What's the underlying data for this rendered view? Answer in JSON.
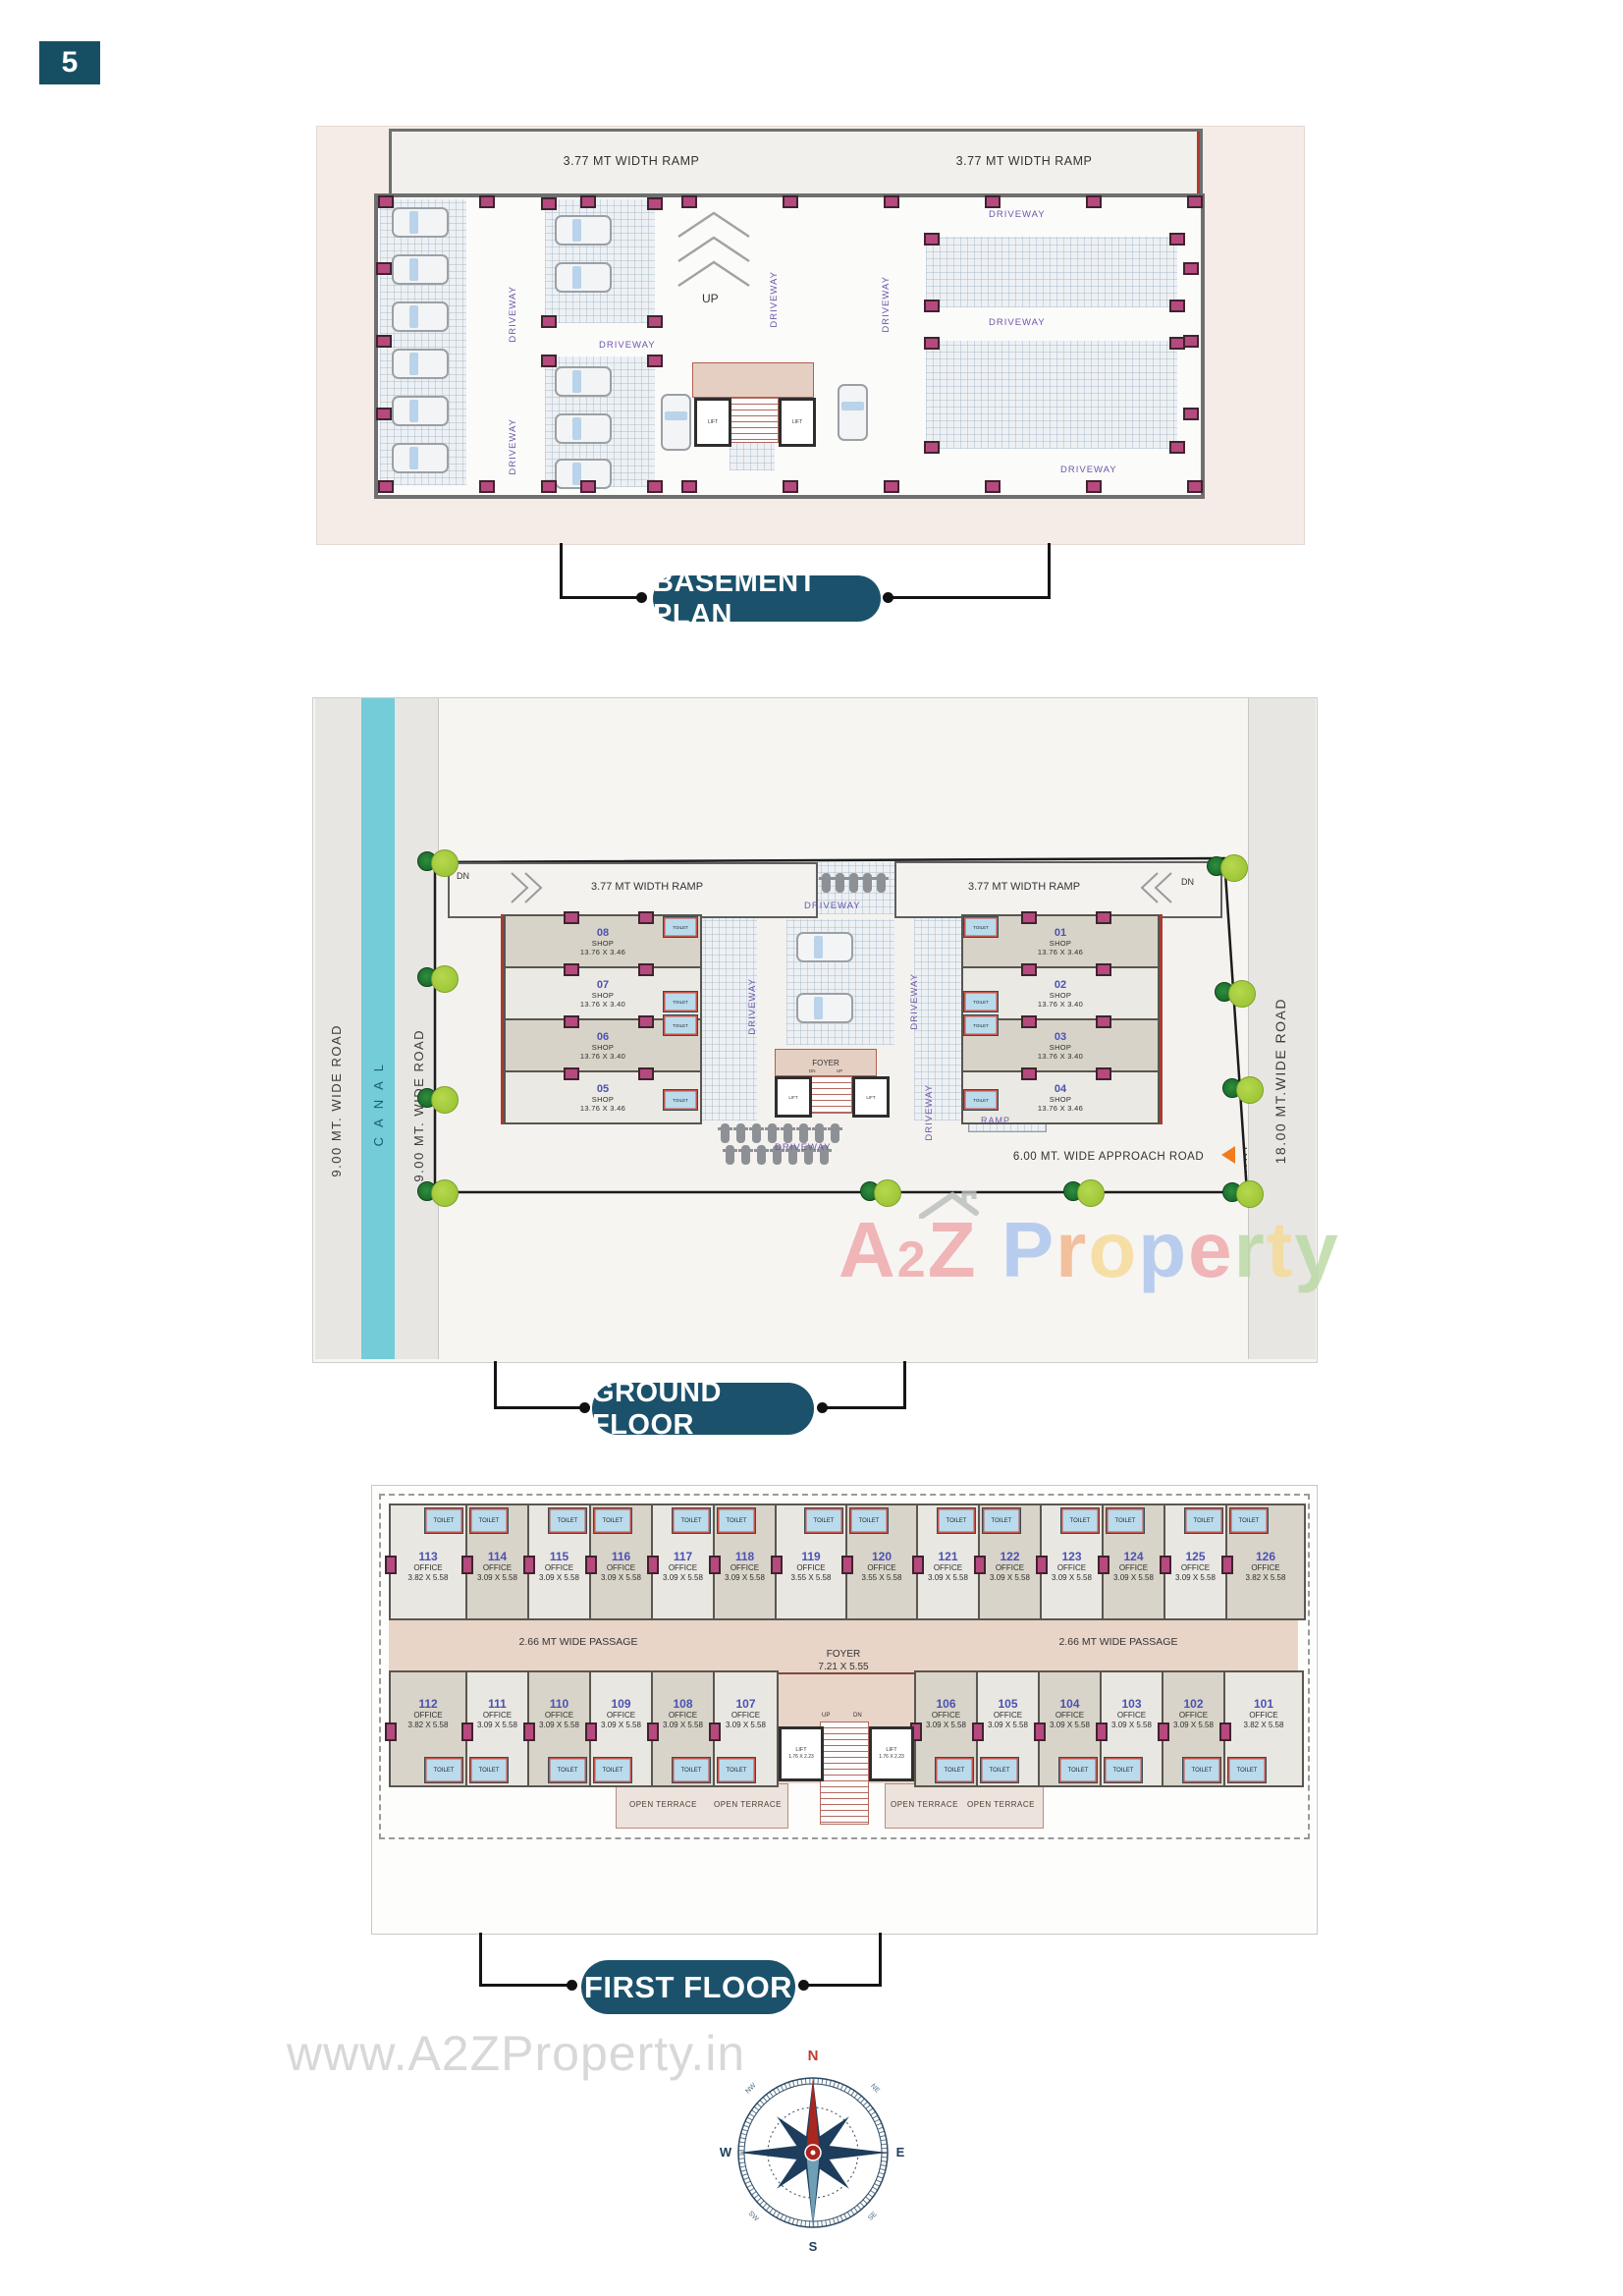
{
  "page_number": "5",
  "theme": {
    "badge_color": "#1b516b",
    "canal_color": "#74ccd9",
    "entry_arrow_color": "#f07c1f",
    "column_color": "#b64a7e",
    "shop_number_color": "#4a52b2",
    "driveway_text_color": "#6f55a8"
  },
  "sections": {
    "basement": {
      "title": "BASEMENT PLAN",
      "ramp_label": "3.77 MT WIDTH RAMP",
      "up_label": "UP",
      "lift_label": "LIFT",
      "driveway_label": "DRIVEWAY"
    },
    "ground": {
      "title": "GROUND FLOOR",
      "road_left_label": "9.00 MT. WIDE ROAD",
      "canal_label": "CANAL",
      "road_inner_label": "9.00 MT. WIDE ROAD",
      "road_right_label": "18.00 MT.WIDE ROAD",
      "entry_label": "ENTRY",
      "dn_label": "DN",
      "up_label": "UP",
      "ramp_label": "3.77 MT WIDTH RAMP",
      "ramp_small_label": "RAMP",
      "approach_label": "6.00 MT. WIDE APPROACH ROAD",
      "driveway_label": "DRIVEWAY",
      "foyer_label": "FOYER",
      "lift_label": "LIFT",
      "toilet_label": "TOILET",
      "shop_word": "SHOP",
      "shops_left": [
        {
          "num": "08",
          "dim": "13.76 X 3.46"
        },
        {
          "num": "07",
          "dim": "13.76 X 3.40"
        },
        {
          "num": "06",
          "dim": "13.76 X 3.40"
        },
        {
          "num": "05",
          "dim": "13.76 X 3.46"
        }
      ],
      "shops_right": [
        {
          "num": "01",
          "dim": "13.76 X 3.46"
        },
        {
          "num": "02",
          "dim": "13.76 X 3.40"
        },
        {
          "num": "03",
          "dim": "13.76 X 3.40"
        },
        {
          "num": "04",
          "dim": "13.76 X 3.46"
        }
      ]
    },
    "first": {
      "title": "FIRST FLOOR",
      "passage_label": "2.66 MT WIDE PASSAGE",
      "foyer_label": "FOYER",
      "foyer_dim": "7.21 X 5.55",
      "lift_label": "LIFT",
      "lift_dim": "1.76 X 2.23",
      "terrace_label": "OPEN TERRACE",
      "toilet_label": "TOILET",
      "office_word": "OFFICE",
      "up_label": "UP",
      "dn_label": "DN",
      "offices_top": [
        {
          "num": "113",
          "dim": "3.82 X 5.58"
        },
        {
          "num": "114",
          "dim": "3.09 X 5.58"
        },
        {
          "num": "115",
          "dim": "3.09 X 5.58"
        },
        {
          "num": "116",
          "dim": "3.09 X 5.58"
        },
        {
          "num": "117",
          "dim": "3.09 X 5.58"
        },
        {
          "num": "118",
          "dim": "3.09 X 5.58"
        },
        {
          "num": "119",
          "dim": "3.55 X 5.58"
        },
        {
          "num": "120",
          "dim": "3.55 X 5.58"
        },
        {
          "num": "121",
          "dim": "3.09 X 5.58"
        },
        {
          "num": "122",
          "dim": "3.09 X 5.58"
        },
        {
          "num": "123",
          "dim": "3.09 X 5.58"
        },
        {
          "num": "124",
          "dim": "3.09 X 5.58"
        },
        {
          "num": "125",
          "dim": "3.09 X 5.58"
        },
        {
          "num": "126",
          "dim": "3.82 X 5.58"
        }
      ],
      "offices_bottom": [
        {
          "num": "112",
          "dim": "3.82 X 5.58"
        },
        {
          "num": "111",
          "dim": "3.09 X 5.58"
        },
        {
          "num": "110",
          "dim": "3.09 X 5.58"
        },
        {
          "num": "109",
          "dim": "3.09 X 5.58"
        },
        {
          "num": "108",
          "dim": "3.09 X 5.58"
        },
        {
          "num": "107",
          "dim": "3.09 X 5.58"
        },
        {
          "num": "106",
          "dim": "3.09 X 5.58"
        },
        {
          "num": "105",
          "dim": "3.09 X 5.58"
        },
        {
          "num": "104",
          "dim": "3.09 X 5.58"
        },
        {
          "num": "103",
          "dim": "3.09 X 5.58"
        },
        {
          "num": "102",
          "dim": "3.09 X 5.58"
        },
        {
          "num": "101",
          "dim": "3.82 X 5.58"
        }
      ]
    }
  },
  "watermark": {
    "brand_letters": [
      {
        "ch": "A",
        "c": "#efa6a8"
      },
      {
        "ch": "2",
        "c": "#efa6a8",
        "small": true
      },
      {
        "ch": "Z",
        "c": "#efa6a8"
      },
      {
        "ch": " ",
        "c": "#ffffff"
      },
      {
        "ch": "P",
        "c": "#a9c3ee"
      },
      {
        "ch": "r",
        "c": "#f2b489"
      },
      {
        "ch": "o",
        "c": "#f6d995"
      },
      {
        "ch": "p",
        "c": "#a9c3ee"
      },
      {
        "ch": "e",
        "c": "#efa6a8"
      },
      {
        "ch": "r",
        "c": "#b8d9a2"
      },
      {
        "ch": "t",
        "c": "#f6d995"
      },
      {
        "ch": "y",
        "c": "#b8d9a2"
      }
    ],
    "url": "www.A2ZProperty.in"
  },
  "compass": {
    "n": "N",
    "e": "E",
    "s": "S",
    "w": "W",
    "ne": "NE",
    "nw": "NW",
    "se": "SE",
    "sw": "SW"
  }
}
